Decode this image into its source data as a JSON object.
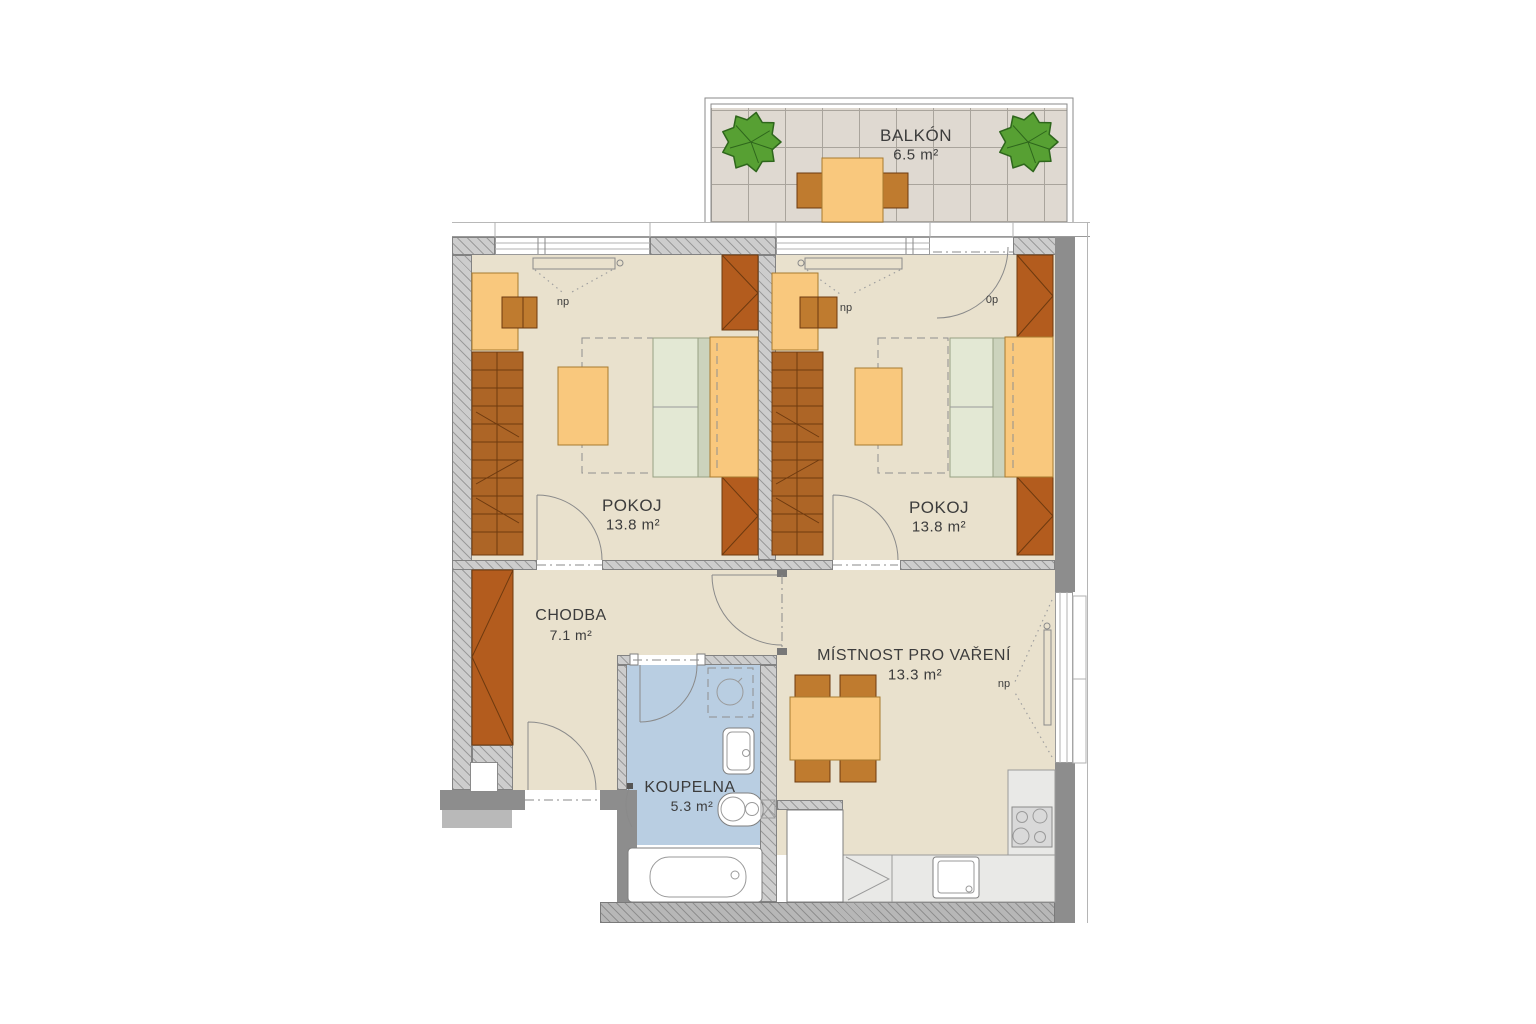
{
  "palette": {
    "floor": "#e9e1cd",
    "bathFloor": "#b9cee2",
    "balconyTile": "#dfd9d1",
    "tileGrid": "#a9a49c",
    "wallHatchBg": "#cdcdcd",
    "wallHatchLine": "#9b9b9b",
    "wallSolid": "#8d8d8d",
    "wallEdge": "#828282",
    "furniture": "#f9c87d",
    "furnitureEdge": "#a87a2f",
    "chair": "#bf7b2f",
    "wardrobe": "#b35c1e",
    "wardrobeLined": "#ad6526",
    "woodEdge": "#6e3a0f",
    "bed": "#e3e8d4",
    "bedEdge": "#97a183",
    "bedStrip": "#ccd3bd",
    "counter": "#e9e9e7",
    "counterEdge": "#9a9a9a",
    "stove": "#d9d9d9",
    "line": "#8a8a8a",
    "text": "#3c3c3c",
    "tree": "#57a033",
    "treeEdge": "#2e661c",
    "step": "#b9b9b9"
  },
  "rooms": {
    "balcony": {
      "name": "BALKÓN",
      "area": "6.5 m²"
    },
    "room1": {
      "name": "POKOJ",
      "area": "13.8 m²"
    },
    "room2": {
      "name": "POKOJ",
      "area": "13.8 m²"
    },
    "hallway": {
      "name": "CHODBA",
      "area": "7.1 m²"
    },
    "bathroom": {
      "name": "KOUPELNA",
      "area": "5.3 m²"
    },
    "kitchen": {
      "name": "MÍSTNOST PRO VAŘENÍ",
      "area": "13.3 m²"
    }
  },
  "annotations": {
    "room1_window": "np",
    "room2_window": "np",
    "kitchen_window": "np",
    "balcony_door": "0p"
  }
}
